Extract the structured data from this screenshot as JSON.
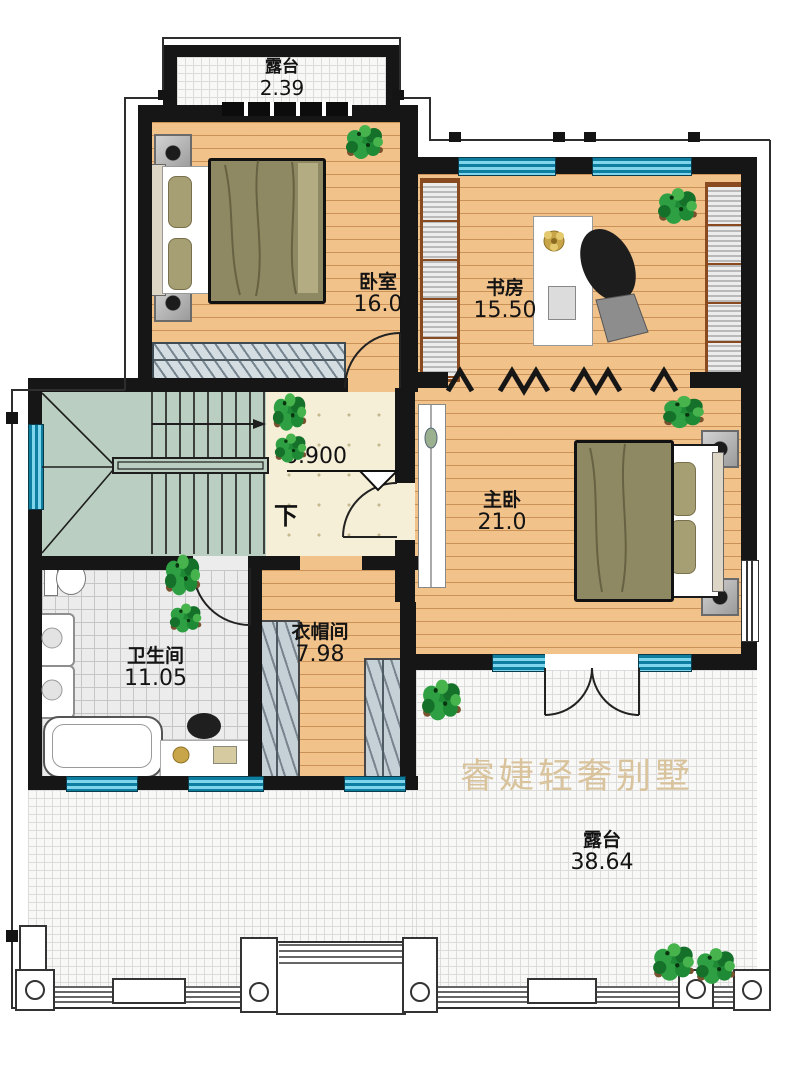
{
  "watermark": "睿婕轻奢别墅",
  "level_marker": {
    "elevation": "6.900",
    "direction_label": "下"
  },
  "rooms": {
    "balcony_top": {
      "name": "露台",
      "area": "2.39"
    },
    "bedroom": {
      "name": "卧室",
      "area": "16.0"
    },
    "study": {
      "name": "书房",
      "area": "15.50"
    },
    "master_bedroom": {
      "name": "主卧",
      "area": "21.0"
    },
    "bathroom": {
      "name": "卫生间",
      "area": "11.05"
    },
    "cloakroom": {
      "name": "衣帽间",
      "area": "7.98"
    },
    "terrace": {
      "name": "露台",
      "area": "38.64"
    }
  },
  "colors": {
    "wall": "#161616",
    "wood_floor": "#f2c28b",
    "stair_fill": "#bacfc1",
    "hall_tile": "#f6efd7",
    "window_teal": "#2aa9cf",
    "watermark": "#d9c39c"
  }
}
